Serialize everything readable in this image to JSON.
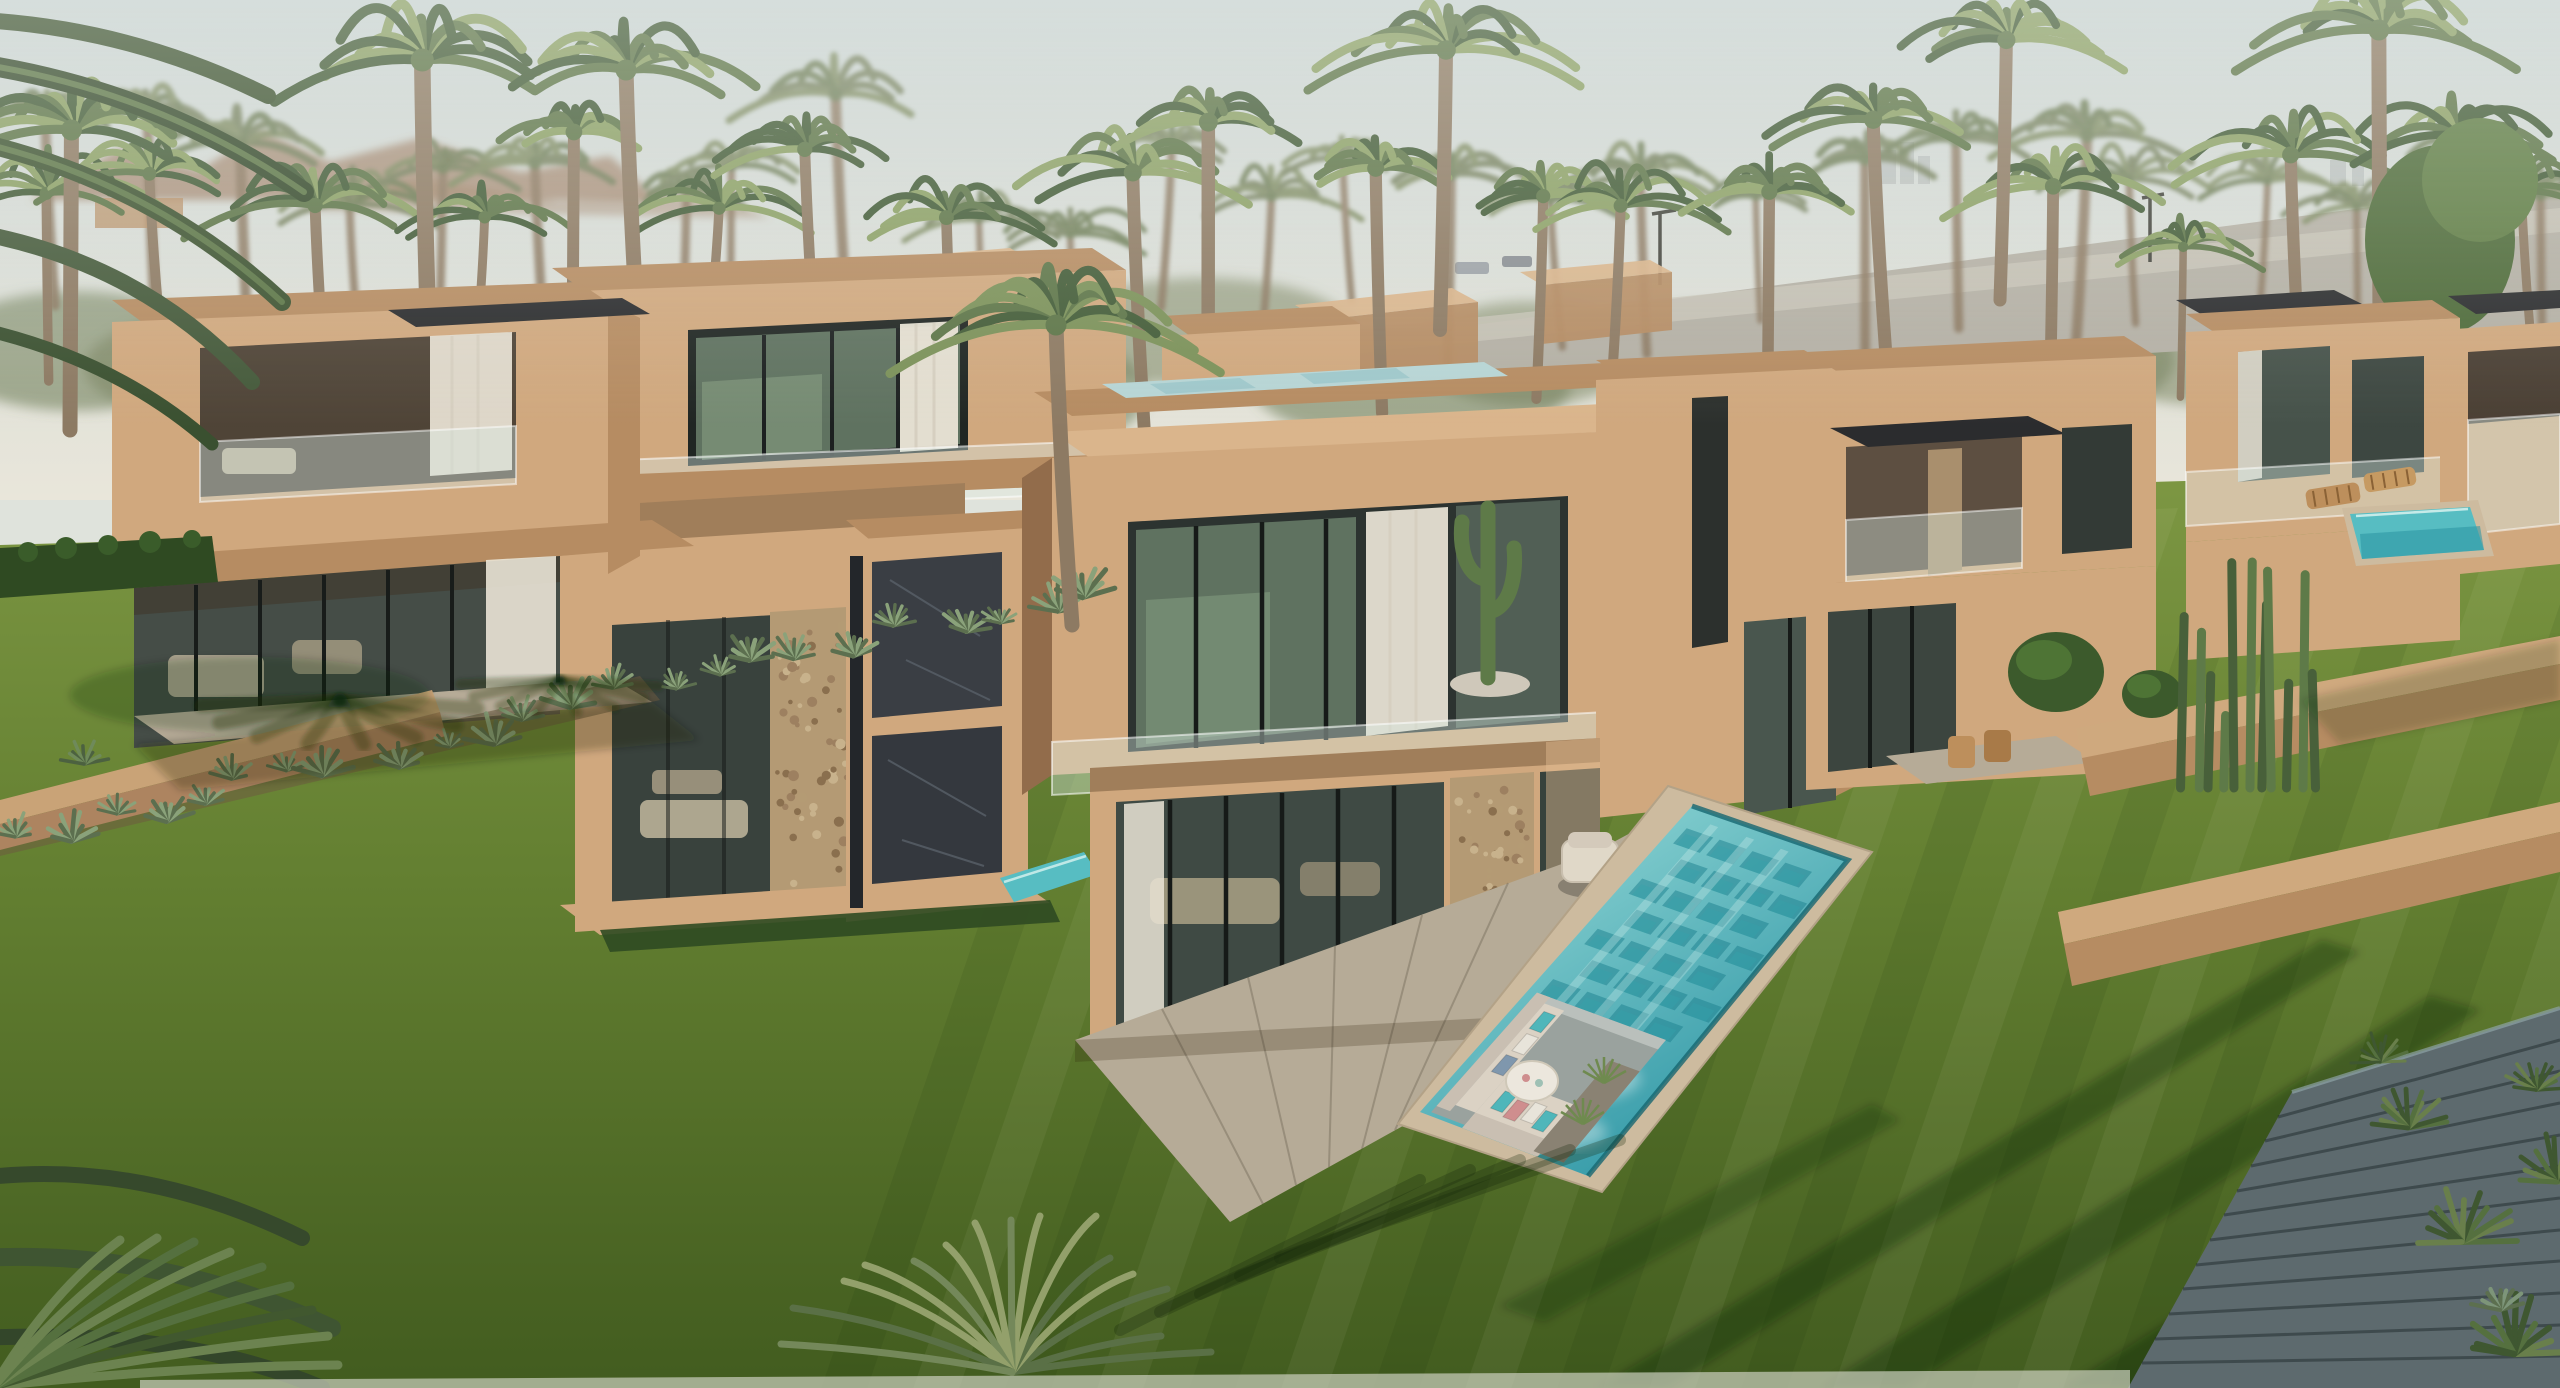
{
  "meta": {
    "type": "architectural-3d-render",
    "subject": "Aerial view of a modern desert villa community: cubic sand-stucco houses among date palms, green lawns, an elongated pool with a sunken lounge, cacti and a distant road",
    "visible_text": "none"
  },
  "palette": {
    "sky_top": "#c9d4d4",
    "sky_horizon": "#e9e6da",
    "haze": "#eef0ea",
    "mountain": "#9b7a5f",
    "city_block": "#9aa0a0",
    "understory": "#76815c",
    "palm_dark": "#435c38",
    "palm_mid": "#5d7548",
    "palm_light": "#8ba065",
    "palm_muted": "#737f5b",
    "trunk": "#8d7a63",
    "road": "#b4b0a5",
    "road_light": "#c9c5b9",
    "villa_light": "#d0a87e",
    "villa_top": "#dab58c",
    "villa_mid": "#b68c62",
    "villa_shadow": "#926c4b",
    "fascia_dark": "#2b2c2e",
    "glass": "#5f7260",
    "glass_dark": "#39423d",
    "glass_reflection": "#88a184",
    "curtain": "#eae4d6",
    "stone": "#b49a74",
    "slate_panel": "#3a3e44",
    "lawn_top": "#7d9743",
    "lawn_mid": "#637f31",
    "lawn_deep": "#425c1f",
    "hedge": "#2f4a22",
    "bush": "#3c5a2c",
    "agave": "#8aa27a",
    "cactus": "#5e7a48",
    "pool_light": "#9fe0dc",
    "pool_mid": "#57bdc2",
    "pool_deep": "#2a93a3",
    "pool_tile": "#1c7f8d",
    "waterline": "#176671",
    "coping": "#cdbb9f",
    "patio": "#b6ab97",
    "sofa_light": "#dbd2c4",
    "sofa_back": "#c9bfb2",
    "pillow_teal": "#4fb6ba",
    "pillow_blue": "#7f97ad",
    "pillow_pink": "#cf8e8e",
    "pillow_white": "#e8e4da",
    "table_white": "#ece7dd",
    "wood": "#bd8f5c",
    "path_slate": "#5d6a6e",
    "soil": "#6e5b3f"
  },
  "scene": {
    "sky": "bright hazy sky",
    "background": [
      "rocky desert ridge on left horizon",
      "dense date-palm grove across the skyline",
      "street with lamp posts behind the villas",
      "faint distant buildings on the right horizon"
    ],
    "buildings": [
      {
        "id": "villa-left-a",
        "features": [
          "flat roof",
          "black awning",
          "recessed balcony with curtains",
          "glass ground floor"
        ]
      },
      {
        "id": "villa-left-b",
        "features": [
          "corner picture window",
          "white curtain",
          "balcony cactus",
          "glass balustrade",
          "stone-clad ground floor with sofas"
        ]
      },
      {
        "id": "entry-volume",
        "features": [
          "dark slate marble panels",
          "water feature at base"
        ]
      },
      {
        "id": "villa-main",
        "features": [
          "rooftop pool",
          "cantilevered upper box",
          "corner glazing",
          "saguaro cactus on balcony",
          "pebble-stone pier",
          "sliding glass doors",
          "stone patio"
        ]
      },
      {
        "id": "villa-mid-right",
        "features": [
          "black canopy awning",
          "glass railing",
          "timber patio chairs"
        ]
      },
      {
        "id": "villas-right",
        "features": [
          "dark roof fascias",
          "balconies",
          "private plunge pool with loungers",
          "terraced garden walls"
        ]
      }
    ],
    "pool": {
      "style": "elongated reflecting pool with sunken lounge pit",
      "contents": [
        "L-shaped beige sofa",
        "teal, blue, pink and white throw pillows",
        "round white coffee table",
        "planter boxes with grasses",
        "geometric teal tile pattern",
        "sky reflections"
      ],
      "patio_furniture": "two beige cube armchairs"
    },
    "vegetation": [
      "date palms",
      "overhanging foreground palm fronds",
      "palm crown at bottom edge",
      "agave bed along garden wall",
      "trimmed hedge",
      "boxwood spheres",
      "saguaro and organ-pipe cacti",
      "yucca clumps by walkway",
      "leafy tree at right"
    ],
    "ground": [
      "striped mowed lawns",
      "long evening tree shadows",
      "tan garden walls",
      "slate paver walkway in bottom-right corner"
    ]
  },
  "generation": {
    "forest_back_count": 26,
    "forest_front_count": 20,
    "agave_count": 24,
    "lawn_stripe_step": 92,
    "random_seed": 7
  }
}
